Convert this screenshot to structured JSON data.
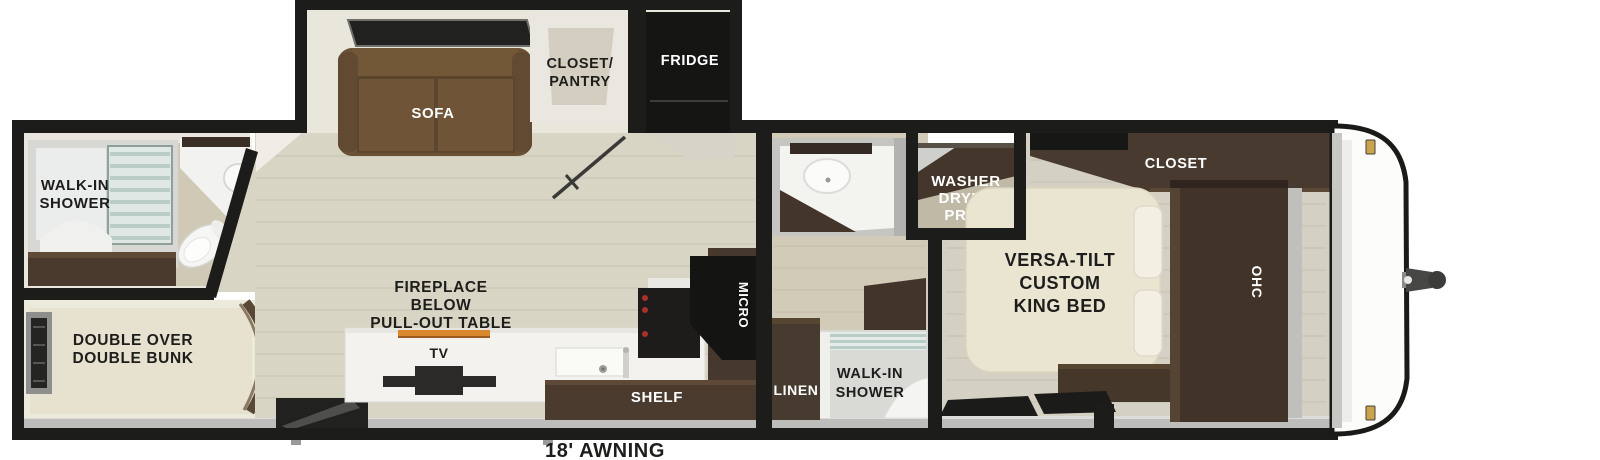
{
  "floorplan": {
    "rear_bathroom": {
      "shower_label_line1": "WALK-IN",
      "shower_label_line2": "SHOWER"
    },
    "bunk_room": {
      "label_line1": "DOUBLE OVER",
      "label_line2": "DOUBLE BUNK"
    },
    "slide_out": {
      "sofa_label": "SOFA",
      "closet_pantry_line1": "CLOSET/",
      "closet_pantry_line2": "PANTRY",
      "fridge_label": "FRIDGE"
    },
    "living_area": {
      "fireplace_line1": "FIREPLACE",
      "fireplace_line2": "BELOW",
      "fireplace_line3": "PULL-OUT TABLE",
      "tv_label": "TV"
    },
    "kitchen": {
      "shelf_label": "SHELF",
      "micro_label": "MICRO"
    },
    "mid_bathroom": {
      "linen_label": "LINEN",
      "shower_line1": "WALK-IN",
      "shower_line2": "SHOWER",
      "washer_line1": "WASHER",
      "washer_line2": "DRYER",
      "washer_line3": "PREP"
    },
    "bedroom": {
      "bed_line1": "VERSA-TILT",
      "bed_line2": "CUSTOM",
      "bed_line3": "KING BED",
      "closet_label": "CLOSET",
      "ohc_label": "OHC"
    },
    "exterior": {
      "awning_label": "18' AWNING"
    }
  },
  "colors": {
    "wall_black": "#1c1c1a",
    "floor_wood": "#d9d5c5",
    "dark_cabinet_wood": "#46382d",
    "sofa_brown": "#6a5035",
    "bed_cream": "#eae5d1",
    "fireplace_amber": "#d8892d",
    "shower_glass": "#b7cdc5",
    "step_gray": "#bdbdbb",
    "gold_clip": "#c9a44c"
  }
}
